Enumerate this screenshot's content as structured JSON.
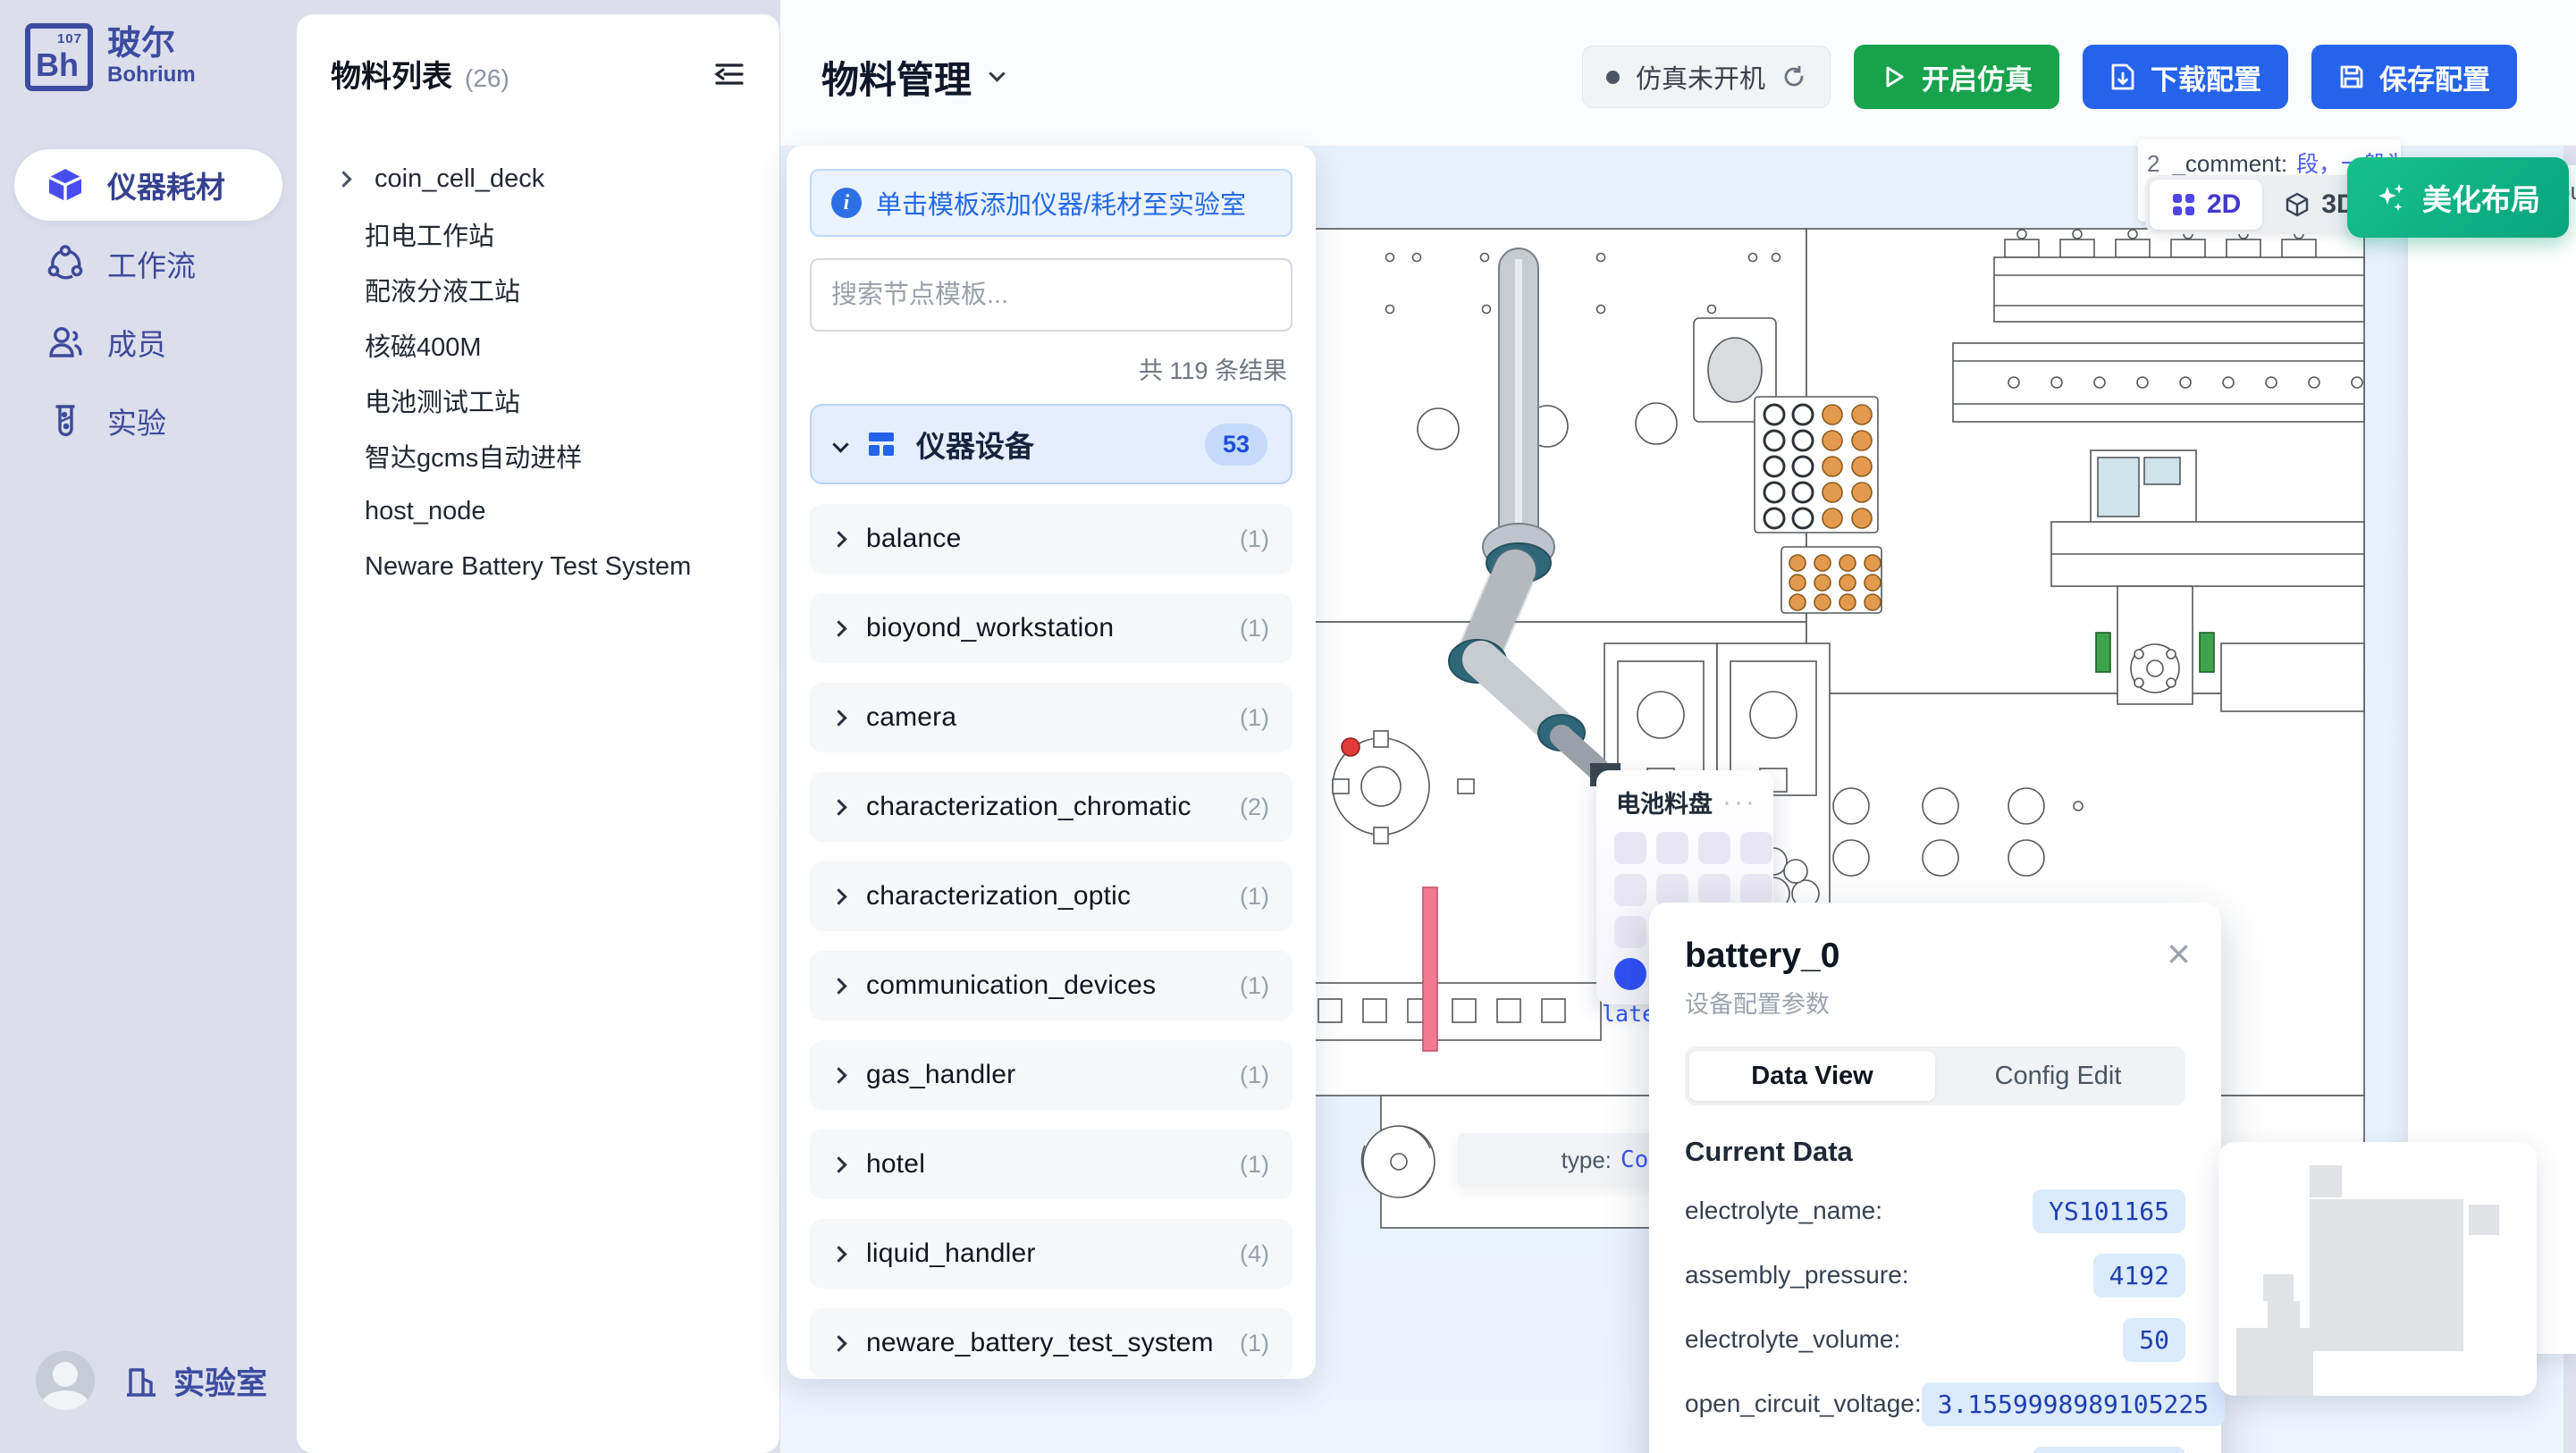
{
  "colors": {
    "accent_blue": "#2563eb",
    "green": "#17a24b",
    "teal_gradient": "#10b981",
    "indigo": "#3c4c9f",
    "value_pill_bg": "#dbeafe",
    "value_pill_text": "#1d3fae"
  },
  "brand": {
    "symbol": "Bh",
    "number": "107",
    "name_zh": "玻尔",
    "name_en": "Bohrium"
  },
  "sidebar": {
    "items": [
      {
        "label": "仪器耗材"
      },
      {
        "label": "工作流"
      },
      {
        "label": "成员"
      },
      {
        "label": "实验"
      }
    ],
    "lab_label": "实验室"
  },
  "materials": {
    "title": "物料列表",
    "count": "(26)",
    "items": [
      "coin_cell_deck",
      "扣电工作站",
      "配液分液工站",
      "核磁400M",
      "电池测试工站",
      "智达gcms自动进样",
      "host_node",
      "Neware Battery Test System"
    ]
  },
  "header": {
    "title": "物料管理",
    "status": "仿真未开机",
    "start_button": "开启仿真",
    "download_button": "下载配置",
    "save_button": "保存配置"
  },
  "templates": {
    "banner": "单击模板添加仪器/耗材至实验室",
    "search_placeholder": "搜索节点模板...",
    "result_count": "共 119 条结果",
    "category": {
      "label": "仪器设备",
      "badge": "53"
    },
    "items": [
      {
        "name": "balance",
        "count": "(1)"
      },
      {
        "name": "bioyond_workstation",
        "count": "(1)"
      },
      {
        "name": "camera",
        "count": "(1)"
      },
      {
        "name": "characterization_chromatic",
        "count": "(2)"
      },
      {
        "name": "characterization_optic",
        "count": "(1)"
      },
      {
        "name": "communication_devices",
        "count": "(1)"
      },
      {
        "name": "gas_handler",
        "count": "(1)"
      },
      {
        "name": "hotel",
        "count": "(1)"
      },
      {
        "name": "liquid_handler",
        "count": "(4)"
      },
      {
        "name": "neware_battery_test_system",
        "count": "(1)"
      }
    ]
  },
  "canvas": {
    "view_2d": "2D",
    "view_3d": "3D",
    "beautify": "美化布局",
    "comment_tooltip": {
      "line_no": "2",
      "key": "_comment:",
      "value": "段，一般为空，stat",
      "value_clipped": "法此图定"
    },
    "type_tooltip": {
      "key": "type:",
      "value": "Coi"
    },
    "side_panel_text": "esou",
    "tray": {
      "title": "电池料盘",
      "menu": "···",
      "plate_label": "late"
    }
  },
  "popup": {
    "title": "battery_0",
    "subtitle": "设备配置参数",
    "close": "×",
    "tabs": [
      "Data View",
      "Config Edit"
    ],
    "section": "Current Data",
    "fields": [
      {
        "label": "electrolyte_name:",
        "value": "YS101165"
      },
      {
        "label": "assembly_pressure:",
        "value": "4192"
      },
      {
        "label": "electrolyte_volume:",
        "value": "50"
      },
      {
        "label": "open_circuit_voltage:",
        "value": "3.1559998989105225"
      },
      {
        "label": "data_electrolyte_code:",
        "value": "LG000014"
      }
    ]
  }
}
